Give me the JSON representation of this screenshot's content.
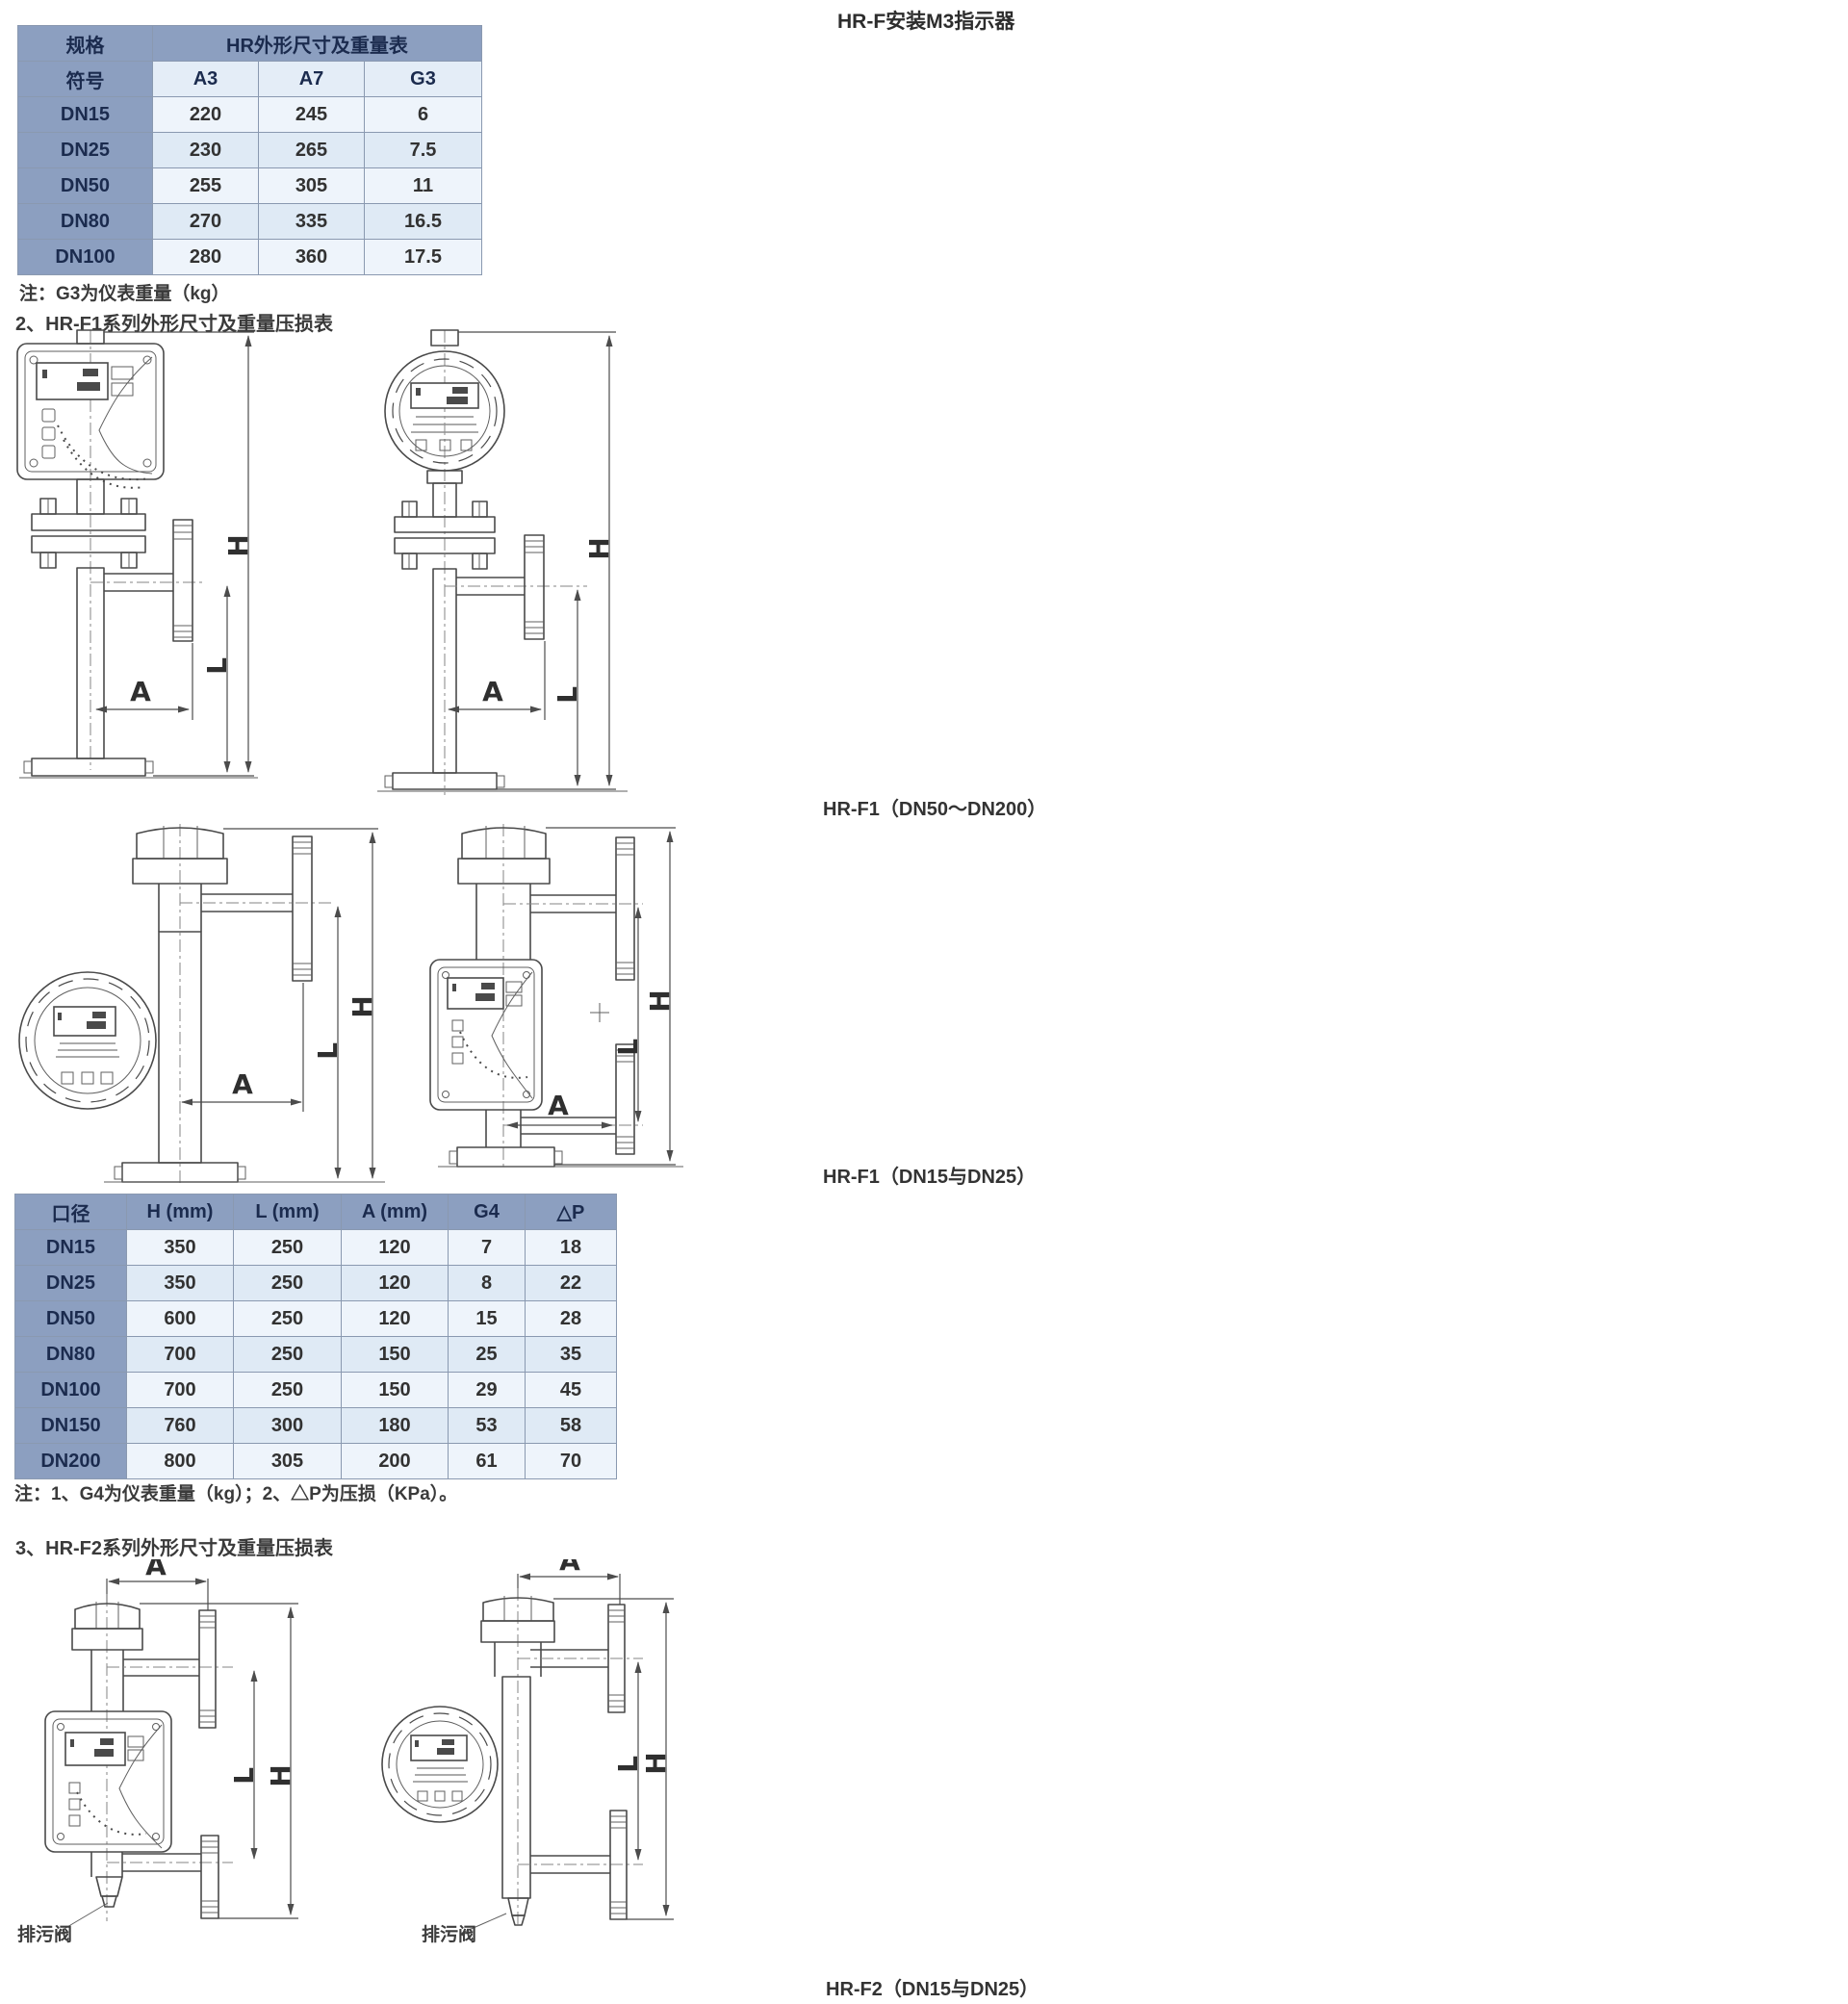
{
  "header": {
    "top_right_label": "HR-F安装M3指示器"
  },
  "table1": {
    "corner_top": "规格",
    "corner_bottom": "符号",
    "title": "HR外形尺寸及重量表",
    "col_a3": "A3",
    "col_a7": "A7",
    "col_g3": "G3",
    "rows": [
      {
        "dn": "DN15",
        "a3": "220",
        "a7": "245",
        "g3": "6"
      },
      {
        "dn": "DN25",
        "a3": "230",
        "a7": "265",
        "g3": "7.5"
      },
      {
        "dn": "DN50",
        "a3": "255",
        "a7": "305",
        "g3": "11"
      },
      {
        "dn": "DN80",
        "a3": "270",
        "a7": "335",
        "g3": "16.5"
      },
      {
        "dn": "DN100",
        "a3": "280",
        "a7": "360",
        "g3": "17.5"
      }
    ],
    "note": "注：G3为仪表重量（kg）"
  },
  "sections": {
    "s2_title": "2、HR-F1系列外形尺寸及重量压损表",
    "s3_title": "3、HR-F2系列外形尺寸及重量压损表"
  },
  "figure_labels": {
    "f1_large": "HR-F1（DN50～DN200）",
    "f1_small": "HR-F1（DN15与DN25）",
    "f2_small": "HR-F2（DN15与DN25）",
    "drain_valve": "排污阀",
    "dim_h": "H",
    "dim_l": "L",
    "dim_a": "A"
  },
  "table2": {
    "headers": {
      "c0": "口径",
      "c1": "H (mm)",
      "c2": "L (mm)",
      "c3": "A (mm)",
      "c4": "G4",
      "c5": "△P"
    },
    "rows": [
      {
        "dn": "DN15",
        "h": "350",
        "l": "250",
        "a": "120",
        "g4": "7",
        "dp": "18"
      },
      {
        "dn": "DN25",
        "h": "350",
        "l": "250",
        "a": "120",
        "g4": "8",
        "dp": "22"
      },
      {
        "dn": "DN50",
        "h": "600",
        "l": "250",
        "a": "120",
        "g4": "15",
        "dp": "28"
      },
      {
        "dn": "DN80",
        "h": "700",
        "l": "250",
        "a": "150",
        "g4": "25",
        "dp": "35"
      },
      {
        "dn": "DN100",
        "h": "700",
        "l": "250",
        "a": "150",
        "g4": "29",
        "dp": "45"
      },
      {
        "dn": "DN150",
        "h": "760",
        "l": "300",
        "a": "180",
        "g4": "53",
        "dp": "58"
      },
      {
        "dn": "DN200",
        "h": "800",
        "l": "305",
        "a": "200",
        "g4": "61",
        "dp": "70"
      }
    ],
    "note": "注：1、G4为仪表重量（kg）；2、△P为压损（KPa）。"
  },
  "colors": {
    "table_header_bg": "#8c9fc0",
    "row_light": "#eef4fb",
    "row_alt": "#dfeaf5",
    "drawing_line": "#4a4a4a"
  }
}
